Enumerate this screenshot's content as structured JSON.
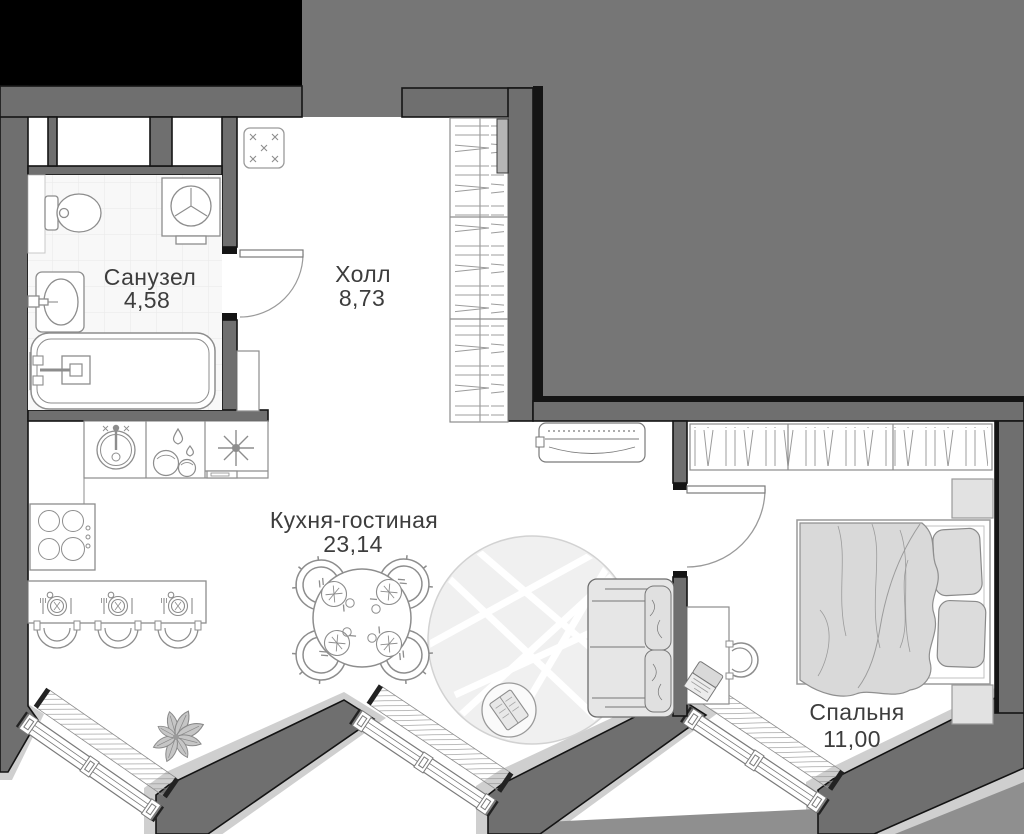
{
  "rooms": [
    {
      "id": "bathroom",
      "name": "Санузел",
      "area": "4,58"
    },
    {
      "id": "hall",
      "name": "Холл",
      "area": "8,73"
    },
    {
      "id": "kitchen_living",
      "name": "Кухня-гостиная",
      "area": "23,14"
    },
    {
      "id": "bedroom",
      "name": "Спальня",
      "area": "11,00"
    }
  ],
  "icons": [
    "bathtub",
    "toilet",
    "bathroom-sink",
    "washing-machine",
    "kitchen-sink",
    "dishwasher",
    "extractor-hood",
    "cooktop",
    "bar-counter",
    "bar-stool",
    "place-setting",
    "dining-table",
    "dining-chair",
    "rug",
    "pouf",
    "book",
    "plant",
    "sofa",
    "desk",
    "desk-chair",
    "laptop",
    "ac-unit",
    "wardrobe",
    "hangers",
    "bed",
    "pillow",
    "blanket",
    "nightstand",
    "window",
    "radiator",
    "door-swing",
    "entrance-mat"
  ],
  "colors": {
    "wall": "#6f6f6f",
    "outline": "#141414",
    "neighbor_fill": "#767676",
    "blackout": "#000000",
    "ground_light": "#cfcfcf",
    "ground_medium": "#8f8f8f",
    "furniture_line": "#8d8d8d",
    "soft_furniture_fill": "#dcdcdc",
    "rug_fill": "#f0f0f0",
    "tile_line": "#e9e9e9",
    "label_text": "#3d3d3d"
  }
}
